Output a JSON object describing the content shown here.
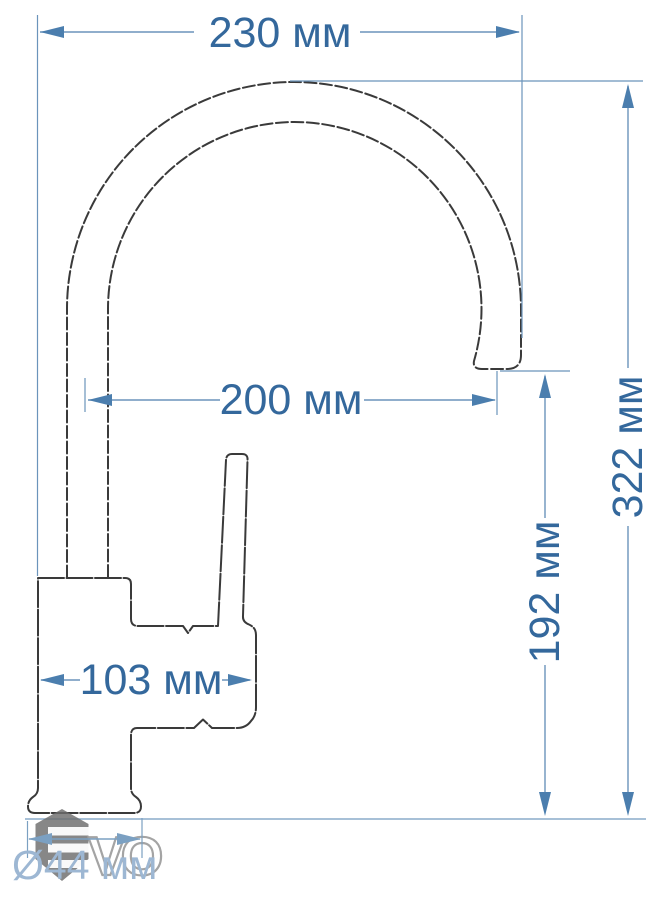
{
  "drawing": {
    "subject": "Kitchen faucet dimensional drawing",
    "units": "мм",
    "dimensions": {
      "total_width": {
        "label": "230 мм",
        "value_mm": 230,
        "axis": "horizontal"
      },
      "spout_reach": {
        "label": "200 мм",
        "value_mm": 200,
        "axis": "horizontal"
      },
      "total_height": {
        "label": "322 мм",
        "value_mm": 322,
        "axis": "vertical"
      },
      "spout_height": {
        "label": "192 мм",
        "value_mm": 192,
        "axis": "vertical"
      },
      "body_length": {
        "label": "103 мм",
        "value_mm": 103,
        "axis": "horizontal"
      },
      "base_diameter": {
        "label": "Ø44 мм",
        "value_mm": 44,
        "axis": "horizontal"
      }
    },
    "watermark": {
      "letters": "VO",
      "description": "EVO brand watermark: grey hexagon with white stripes forming E, outlined VO letters"
    },
    "colors": {
      "background": "#ffffff",
      "dimension_text": "#34689c",
      "dimension_line": "#6b94bb",
      "arrow_fill": "#4b7eae",
      "baseline": "#8aabca",
      "faded_dimension": "#9db7d3",
      "outline": "#3a3a3a",
      "watermark_grey": "#6d6d6d"
    }
  }
}
